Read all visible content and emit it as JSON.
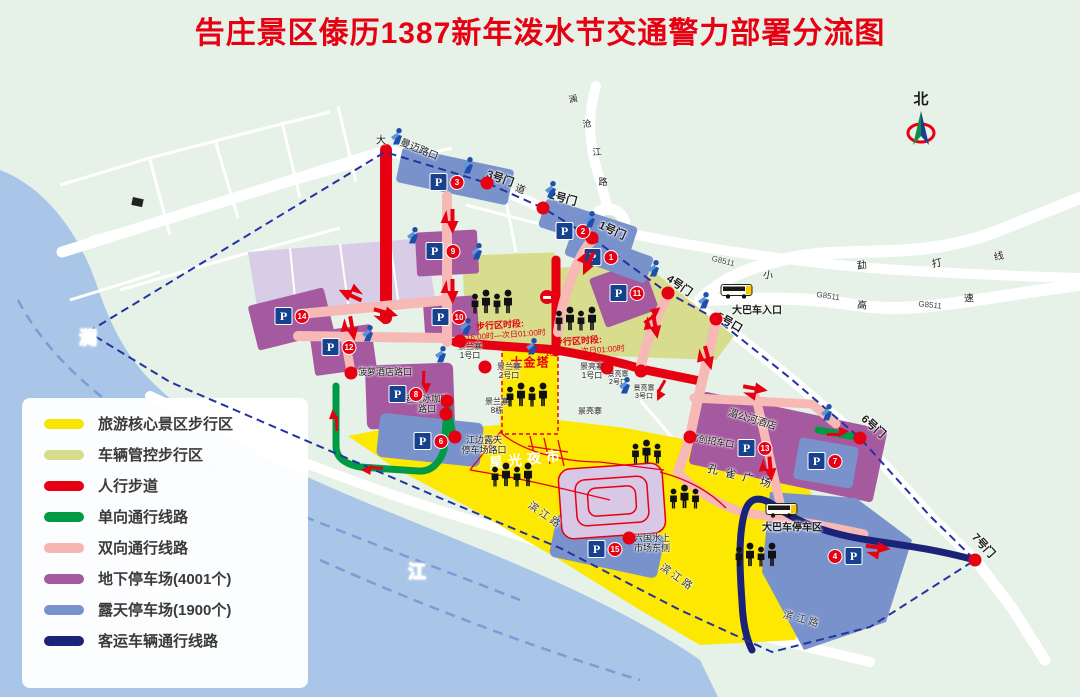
{
  "title": "告庄景区傣历1387新年泼水节交通警力部署分流图",
  "title_color": "#e60012",
  "north_label": "北",
  "parking_sign": "P",
  "palette": {
    "core_walk_yellow": "#f7e400",
    "managed_walk_olive": "#d7dd8d",
    "footpath_red": "#e60012",
    "oneway_green": "#009a44",
    "twoway_pink": "#f6b5b2",
    "underground_purple": "#a55a9f",
    "openair_blue": "#7a92cc",
    "coach_navy": "#1b2378",
    "river_blue": "#a9c6e8",
    "land_green": "#e6f1e8"
  },
  "legend": {
    "items": [
      {
        "label": "旅游核心景区步行区",
        "color": "#f7e400"
      },
      {
        "label": "车辆管控步行区",
        "color": "#d7dd8d"
      },
      {
        "label": "人行步道",
        "color": "#e60012"
      },
      {
        "label": "单向通行线路",
        "color": "#009a44"
      },
      {
        "label": "双向通行线路",
        "color": "#f6b5b2"
      },
      {
        "label": "地下停车场(4001个)",
        "color": "#a55a9f"
      },
      {
        "label": "露天停车场(1900个)",
        "color": "#7a92cc"
      },
      {
        "label": "客运车辆通行线路",
        "color": "#1b2378"
      }
    ]
  },
  "map": {
    "gates": [
      {
        "label": "3号门",
        "x": 500,
        "y": 179,
        "rot": 20
      },
      {
        "label": "2号门",
        "x": 563,
        "y": 199,
        "rot": 15
      },
      {
        "label": "1号门",
        "x": 612,
        "y": 231,
        "rot": 25
      },
      {
        "label": "4号门",
        "x": 679,
        "y": 286,
        "rot": 35
      },
      {
        "label": "5号口",
        "x": 729,
        "y": 323,
        "rot": 30
      },
      {
        "label": "6号门",
        "x": 873,
        "y": 427,
        "rot": 42
      },
      {
        "label": "7号门",
        "x": 983,
        "y": 546,
        "rot": 48
      }
    ],
    "labels": [
      {
        "t": "曼迈路口",
        "x": 419,
        "y": 150,
        "rot": 22,
        "fs": 10
      },
      {
        "t": "大",
        "x": 381,
        "y": 141,
        "fs": 10
      },
      {
        "t": "道",
        "x": 520,
        "y": 190,
        "rot": 20,
        "fs": 10
      },
      {
        "t": "澜",
        "x": 88,
        "y": 338,
        "fs": 18,
        "c": "#ffffff",
        "b": true
      },
      {
        "t": "江",
        "x": 417,
        "y": 572,
        "fs": 18,
        "c": "#ffffff",
        "b": true
      },
      {
        "t": "澜",
        "x": 573,
        "y": 99,
        "fs": 9,
        "rot": -12
      },
      {
        "t": "沧",
        "x": 587,
        "y": 124,
        "fs": 9,
        "rot": -8
      },
      {
        "t": "江",
        "x": 597,
        "y": 152,
        "fs": 9,
        "rot": -5
      },
      {
        "t": "路",
        "x": 603,
        "y": 182,
        "fs": 9,
        "rot": 0
      },
      {
        "t": "G8511",
        "x": 723,
        "y": 262,
        "rot": 14,
        "fs": 8,
        "c": "#444444"
      },
      {
        "t": "G8511",
        "x": 828,
        "y": 297,
        "rot": 8,
        "fs": 8,
        "c": "#444444"
      },
      {
        "t": "G8511",
        "x": 930,
        "y": 306,
        "rot": 6,
        "fs": 8,
        "c": "#444444"
      },
      {
        "t": "勐",
        "x": 862,
        "y": 266,
        "rot": -10,
        "fs": 10
      },
      {
        "t": "打",
        "x": 937,
        "y": 264,
        "rot": -10,
        "fs": 10
      },
      {
        "t": "线",
        "x": 999,
        "y": 257,
        "rot": -12,
        "fs": 10
      },
      {
        "t": "小",
        "x": 768,
        "y": 276,
        "rot": 10,
        "fs": 10
      },
      {
        "t": "高",
        "x": 862,
        "y": 306,
        "rot": 6,
        "fs": 10
      },
      {
        "t": "速",
        "x": 969,
        "y": 299,
        "rot": -4,
        "fs": 10
      },
      {
        "t": "滨江路",
        "x": 545,
        "y": 516,
        "rot": 35,
        "fs": 10,
        "ls": 3,
        "c": "#333333"
      },
      {
        "t": "滨江路",
        "x": 677,
        "y": 578,
        "rot": 35,
        "fs": 10,
        "ls": 3,
        "c": "#333333"
      },
      {
        "t": "滨江路",
        "x": 802,
        "y": 620,
        "rot": 15,
        "fs": 10,
        "ls": 3,
        "c": "#333333"
      },
      {
        "t": "星光夜市",
        "x": 527,
        "y": 460,
        "rot": -6,
        "fs": 14,
        "c": "#ffffff",
        "b": true,
        "ls": 5,
        "halo": false
      },
      {
        "t": "大金塔",
        "x": 530,
        "y": 363,
        "fs": 12,
        "c": "#e60012",
        "b": true,
        "ls": 1,
        "halo": false
      },
      {
        "t": "步行区时段:",
        "x": 500,
        "y": 325,
        "rot": -4,
        "fs": 9,
        "c": "#e60012",
        "b": true,
        "halo": false
      },
      {
        "t": "16:00时—次日01:00时",
        "x": 506,
        "y": 336,
        "rot": -4,
        "fs": 8,
        "c": "#e60012",
        "halo": false
      },
      {
        "t": "步行区时段:",
        "x": 578,
        "y": 341,
        "rot": -4,
        "fs": 9,
        "c": "#e60012",
        "b": true,
        "halo": false
      },
      {
        "t": "16:00时—次日01:00时",
        "x": 585,
        "y": 352,
        "rot": -4,
        "fs": 8,
        "c": "#e60012",
        "halo": false
      },
      {
        "t": "湄公河酒店",
        "x": 752,
        "y": 420,
        "rot": 17,
        "fs": 10
      },
      {
        "t": "孔 雀 广 场",
        "x": 740,
        "y": 477,
        "rot": 14,
        "fs": 11,
        "ls": 2
      },
      {
        "t": "亿创招车口",
        "x": 712,
        "y": 441,
        "rot": 10,
        "fs": 9
      },
      {
        "t": "六国水上\n市场东侧",
        "x": 652,
        "y": 543,
        "fs": 9
      },
      {
        "t": "江边露天\n停车场路口",
        "x": 484,
        "y": 445,
        "fs": 9
      },
      {
        "t": "老挝冰咖啡\n路口",
        "x": 427,
        "y": 404,
        "fs": 9
      },
      {
        "t": "菠萝酒店路口",
        "x": 385,
        "y": 372,
        "fs": 9
      },
      {
        "t": "景兰寨\n1号口",
        "x": 470,
        "y": 352,
        "fs": 8
      },
      {
        "t": "景兰寨\n2号口",
        "x": 509,
        "y": 372,
        "fs": 8
      },
      {
        "t": "景亮寨\n1号口",
        "x": 592,
        "y": 372,
        "fs": 8
      },
      {
        "t": "景亮寨\n2号口",
        "x": 618,
        "y": 379,
        "fs": 7
      },
      {
        "t": "景亮寨\n3号口",
        "x": 644,
        "y": 393,
        "fs": 7
      },
      {
        "t": "景兰寨\n8栋",
        "x": 497,
        "y": 407,
        "fs": 8
      },
      {
        "t": "景亮寨",
        "x": 590,
        "y": 412,
        "fs": 8
      },
      {
        "t": "大巴车入口",
        "x": 757,
        "y": 311,
        "fs": 10,
        "b": true
      },
      {
        "t": "大巴车停车区",
        "x": 792,
        "y": 528,
        "fs": 10,
        "b": true
      }
    ],
    "parkings": [
      {
        "n": "3",
        "x": 447,
        "y": 182
      },
      {
        "n": "2",
        "x": 573,
        "y": 231
      },
      {
        "n": "1",
        "x": 601,
        "y": 257
      },
      {
        "n": "9",
        "x": 443,
        "y": 251
      },
      {
        "n": "11",
        "x": 627,
        "y": 293
      },
      {
        "n": "14",
        "x": 292,
        "y": 316
      },
      {
        "n": "10",
        "x": 449,
        "y": 317
      },
      {
        "n": "12",
        "x": 339,
        "y": 347
      },
      {
        "n": "8",
        "x": 406,
        "y": 394
      },
      {
        "n": "6",
        "x": 431,
        "y": 441
      },
      {
        "n": "13",
        "x": 755,
        "y": 448
      },
      {
        "n": "7",
        "x": 825,
        "y": 461
      },
      {
        "n": "15",
        "x": 605,
        "y": 549
      },
      {
        "n": "4",
        "x": 845,
        "y": 556,
        "rev": true
      }
    ],
    "dots": [
      {
        "x": 487,
        "y": 183
      },
      {
        "x": 543,
        "y": 208
      },
      {
        "x": 592,
        "y": 238
      },
      {
        "x": 668,
        "y": 293
      },
      {
        "x": 716,
        "y": 319
      },
      {
        "x": 860,
        "y": 438
      },
      {
        "x": 975,
        "y": 560
      },
      {
        "x": 351,
        "y": 373
      },
      {
        "x": 447,
        "y": 401
      },
      {
        "x": 446,
        "y": 414
      },
      {
        "x": 455,
        "y": 437
      },
      {
        "x": 629,
        "y": 538
      },
      {
        "x": 690,
        "y": 437
      },
      {
        "x": 460,
        "y": 341
      },
      {
        "x": 485,
        "y": 367
      },
      {
        "x": 607,
        "y": 368
      },
      {
        "x": 641,
        "y": 371
      }
    ],
    "no_entry": [
      {
        "x": 547,
        "y": 297
      }
    ],
    "police": [
      {
        "x": 397,
        "y": 139
      },
      {
        "x": 468,
        "y": 168
      },
      {
        "x": 551,
        "y": 192
      },
      {
        "x": 590,
        "y": 222
      },
      {
        "x": 654,
        "y": 271
      },
      {
        "x": 704,
        "y": 303
      },
      {
        "x": 827,
        "y": 415
      },
      {
        "x": 413,
        "y": 238
      },
      {
        "x": 477,
        "y": 254
      },
      {
        "x": 466,
        "y": 329
      },
      {
        "x": 532,
        "y": 349
      },
      {
        "x": 368,
        "y": 336
      },
      {
        "x": 441,
        "y": 357
      },
      {
        "x": 625,
        "y": 388
      }
    ],
    "crowds": [
      {
        "x": 493,
        "y": 305,
        "n": 4
      },
      {
        "x": 577,
        "y": 322,
        "n": 4
      },
      {
        "x": 528,
        "y": 398,
        "n": 4
      },
      {
        "x": 513,
        "y": 478,
        "n": 4
      },
      {
        "x": 648,
        "y": 455,
        "n": 3
      },
      {
        "x": 686,
        "y": 500,
        "n": 3
      },
      {
        "x": 757,
        "y": 558,
        "n": 4
      }
    ],
    "buses": [
      {
        "x": 737,
        "y": 293
      },
      {
        "x": 782,
        "y": 512
      }
    ],
    "arrows": [
      {
        "x": 447,
        "y": 222,
        "rot": 90,
        "k": "two"
      },
      {
        "x": 447,
        "y": 292,
        "rot": 90,
        "k": "two"
      },
      {
        "x": 385,
        "y": 318,
        "rot": 15,
        "k": "two"
      },
      {
        "x": 352,
        "y": 290,
        "rot": 205,
        "k": "two"
      },
      {
        "x": 347,
        "y": 330,
        "rot": 80,
        "k": "two"
      },
      {
        "x": 583,
        "y": 262,
        "rot": 115,
        "k": "two"
      },
      {
        "x": 650,
        "y": 328,
        "rot": 80,
        "k": "two"
      },
      {
        "x": 703,
        "y": 360,
        "rot": 75,
        "k": "two"
      },
      {
        "x": 660,
        "y": 390,
        "rot": 120,
        "k": "one"
      },
      {
        "x": 653,
        "y": 316,
        "rot": -35,
        "k": "one"
      },
      {
        "x": 755,
        "y": 394,
        "rot": 10,
        "k": "two"
      },
      {
        "x": 765,
        "y": 470,
        "rot": 85,
        "k": "two"
      },
      {
        "x": 878,
        "y": 553,
        "rot": 8,
        "k": "two"
      },
      {
        "x": 336,
        "y": 420,
        "rot": 268,
        "k": "one"
      },
      {
        "x": 372,
        "y": 468,
        "rot": 185,
        "k": "one"
      },
      {
        "x": 424,
        "y": 382,
        "rot": 92,
        "k": "one"
      },
      {
        "x": 838,
        "y": 434,
        "rot": 0,
        "k": "one"
      }
    ]
  }
}
